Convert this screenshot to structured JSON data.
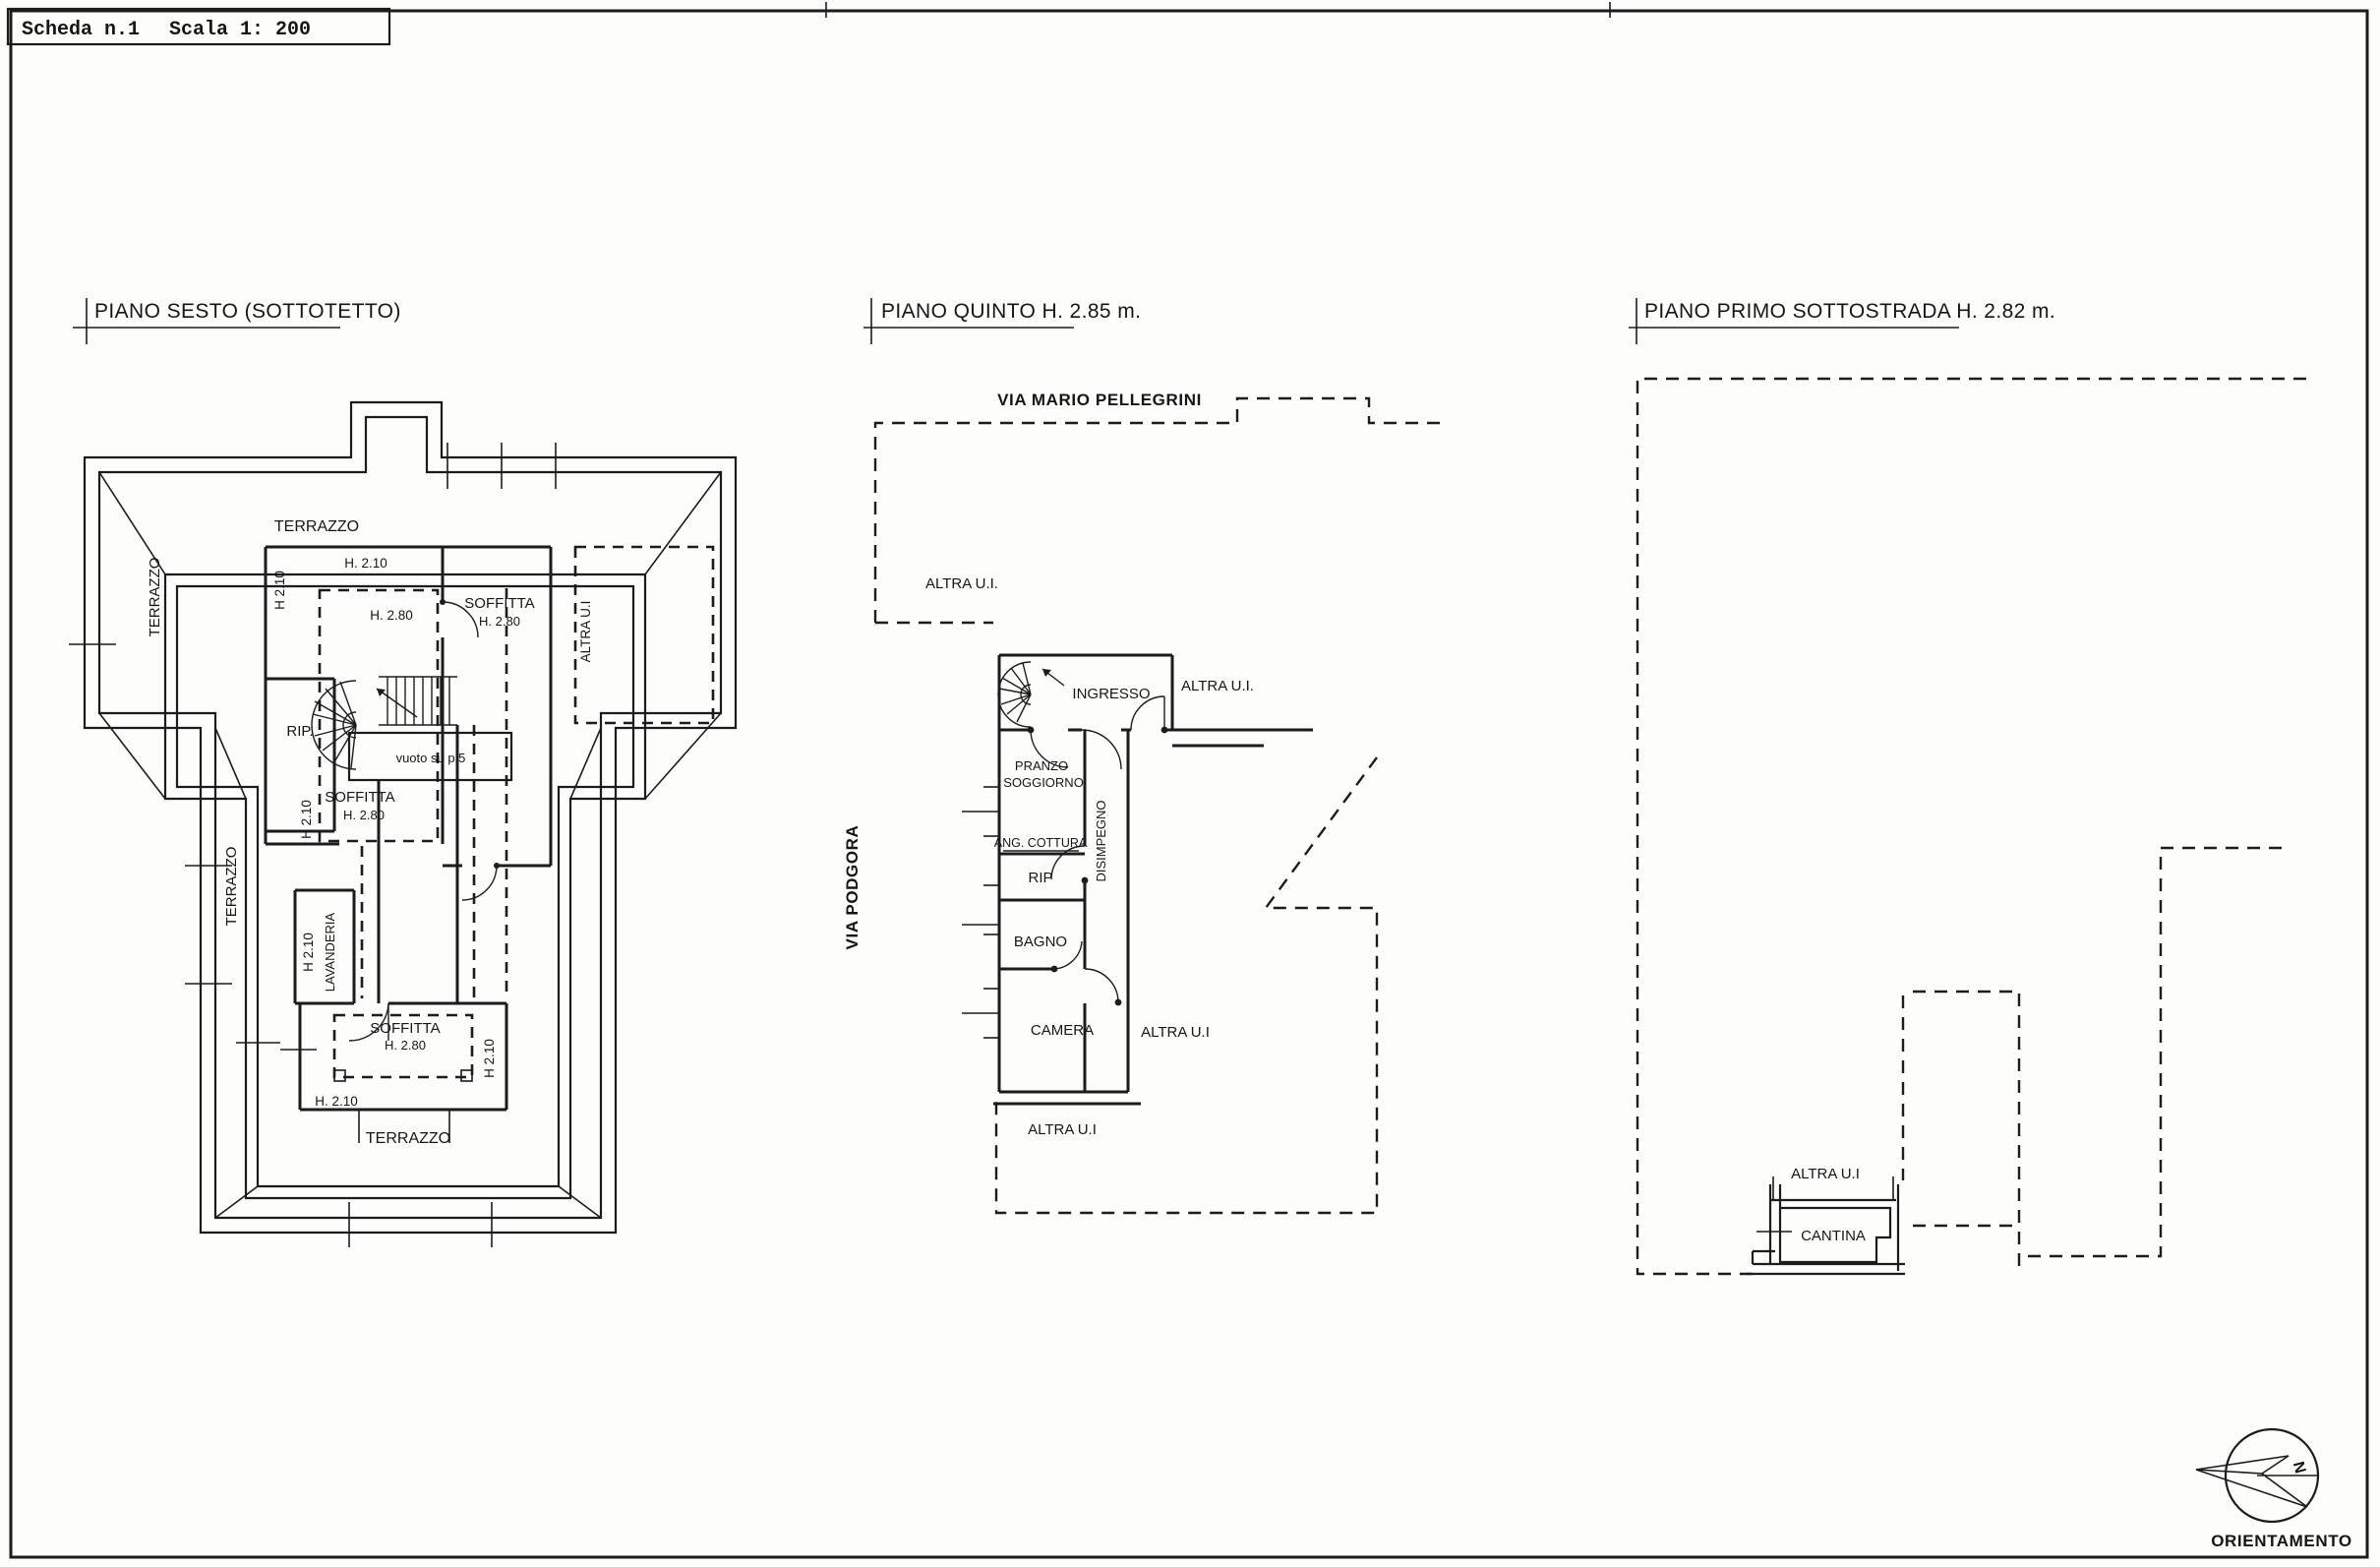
{
  "header": {
    "sheet_label": "Scheda n.1",
    "scale_label": "Scala 1: 200"
  },
  "plans": {
    "sesto": {
      "title": "PIANO SESTO (SOTTOTETTO)",
      "labels": {
        "terrazzo_top": "TERRAZZO",
        "terrazzo_left": "TERRAZZO",
        "terrazzo_mid": "TERRAZZO",
        "terrazzo_bottom": "TERRAZZO",
        "h210_top": "H. 2.10",
        "h210_left": "H 2.10",
        "h280_upper": "H. 2.80",
        "rip": "RIP.",
        "vuoto": "vuoto su p.5",
        "soffitta_right_1": "SOFFITTA",
        "soffitta_right_2": "H. 2.80",
        "altra_ui_right": "ALTRA U.I",
        "h210_mid": "H 2.10",
        "soffitta_mid_1": "SOFFITTA",
        "soffitta_mid_2": "H. 2.80",
        "h210_lav": "H 2.10",
        "lavanderia": "LAVANDERIA",
        "soffitta_bot_1": "SOFFITTA",
        "soffitta_bot_2": "H. 2.80",
        "h210_bot_right": "H 2.10",
        "h210_bottom": "H. 2.10"
      }
    },
    "quinto": {
      "title": "PIANO QUINTO H. 2.85 m.",
      "labels": {
        "street_top": "VIA MARIO PELLEGRINI",
        "street_left": "VIA PODGORA",
        "ingresso": "INGRESSO",
        "altra_ui_top": "ALTRA U.I.",
        "altra_ui_left": "ALTRA U.I.",
        "pranzo_1": "PRANZO",
        "pranzo_2": "SOGGIORNO",
        "ang_cottura": "ANG. COTTURA",
        "disimpegno": "DISIMPEGNO",
        "rip": "RIP",
        "bagno": "BAGNO",
        "camera": "CAMERA",
        "altra_ui_right": "ALTRA U.I",
        "altra_ui_bottom": "ALTRA U.I"
      }
    },
    "sottostrada": {
      "title": "PIANO PRIMO SOTTOSTRADA  H. 2.82 m.",
      "labels": {
        "altra_ui": "ALTRA U.I",
        "cantina": "CANTINA"
      }
    }
  },
  "compass": {
    "label": "ORIENTAMENTO",
    "north": "N"
  }
}
